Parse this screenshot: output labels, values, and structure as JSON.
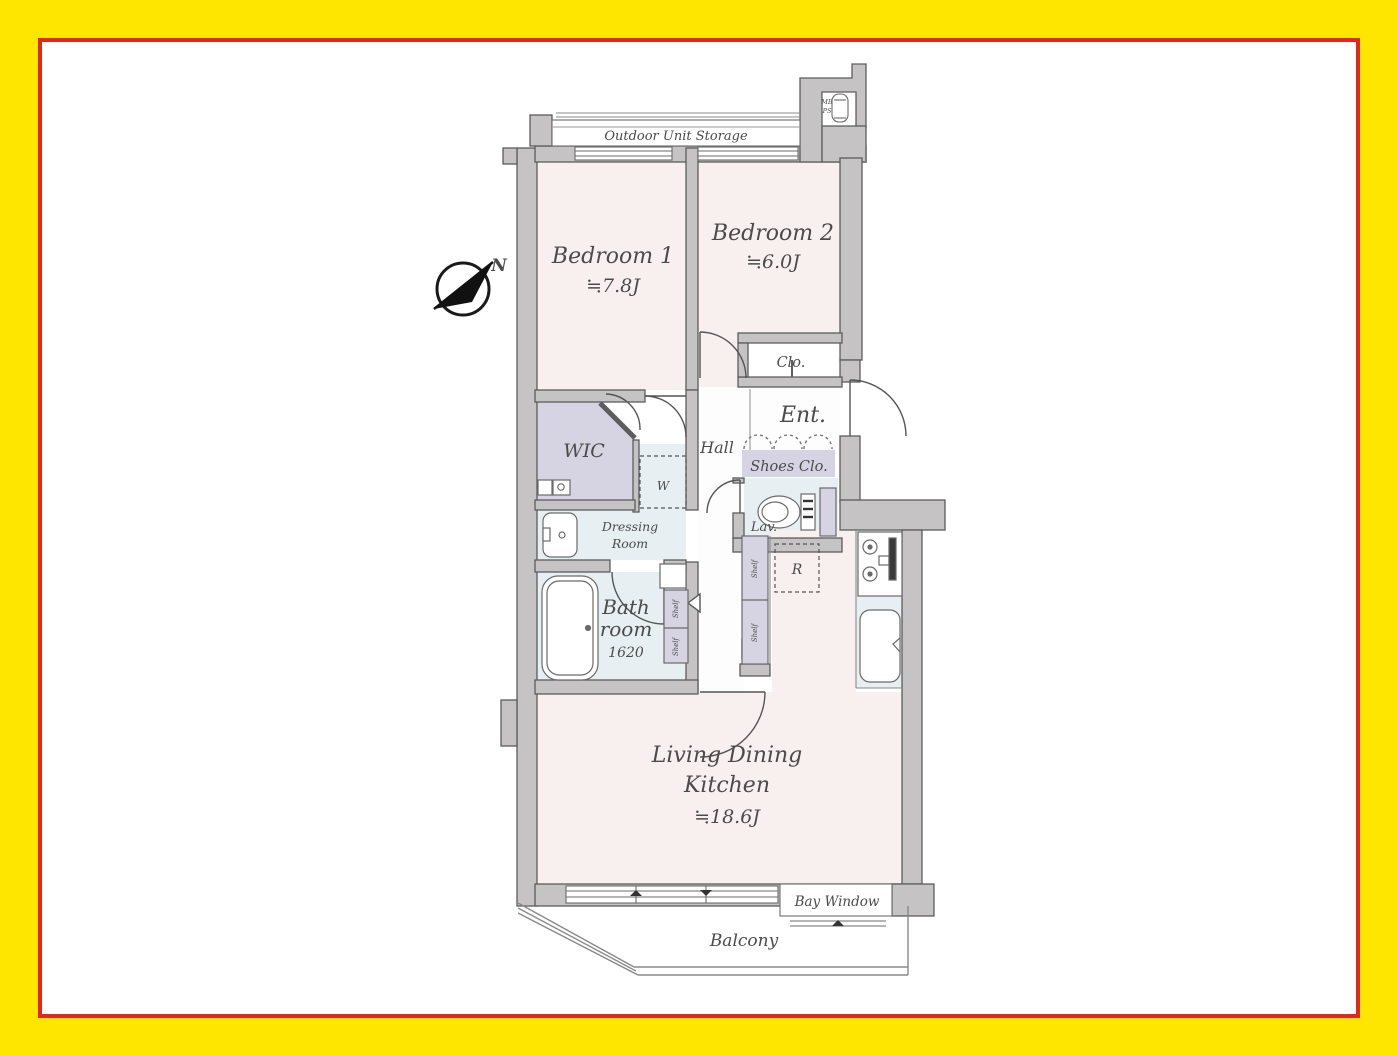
{
  "frame": {
    "outer_color": "#ffe600",
    "inner_border_color": "#e2271f"
  },
  "colors": {
    "wall_fill": "#c5c3c3",
    "wall_stroke": "#5d5d5d",
    "room_pink": "#f8f0ee",
    "wet_blue": "#e7eff3",
    "closet_lavender": "#d6d3e2",
    "text_gray": "#4c4b4b"
  },
  "compass": {
    "north_label": "N"
  },
  "labels": {
    "outdoor_unit_storage": "Outdoor Unit Storage",
    "mb": "MB",
    "ps": "PS",
    "bedroom1_name": "Bedroom 1",
    "bedroom1_area": "≒7.8J",
    "bedroom2_name": "Bedroom 2",
    "bedroom2_area": "≒6.0J",
    "clo": "Clo.",
    "ent": "Ent.",
    "hall": "Hall",
    "shoes_clo": "Shoes Clo.",
    "wic": "WIC",
    "washer": "W",
    "dressing_line1": "Dressing",
    "dressing_line2": "Room",
    "bath_line1": "Bath",
    "bath_line2": "room",
    "bath_size": "1620",
    "lav": "Lav.",
    "fridge": "R",
    "shelf": "Shelf",
    "ldk_line1": "Living Dining",
    "ldk_line2": "Kitchen",
    "ldk_area": "≒18.6J",
    "bay_window": "Bay Window",
    "balcony": "Balcony"
  }
}
